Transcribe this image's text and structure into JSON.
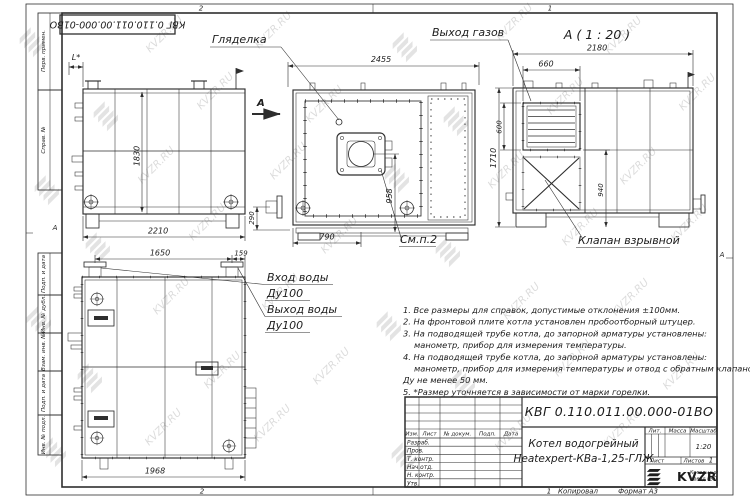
{
  "sheet": {
    "doc_number": "КВГ 0.110.011.00.000-01ВО",
    "watermark_text": "KVZR.RU",
    "zone_top_left": "2",
    "zone_top_right": "1",
    "zone_bottom_left": "2",
    "marker_left": "А",
    "marker_right": "А",
    "margin": {
      "perv": "Перв. примен.",
      "sprav": "Справ. №",
      "podp1": "Подп. и дата",
      "dubl": "Инв. № дубл.",
      "vzam": "Взам. инв. №",
      "podp2": "Подп. и дата",
      "podl": "Инв. № подл."
    }
  },
  "views": {
    "side": {
      "dim_l": "L*",
      "dim_h": "1830",
      "dim_w": "2210"
    },
    "front": {
      "sight": "Гляделка",
      "see_note": "См.п.2",
      "cut": "А",
      "dim_w": "2455",
      "dim_flue": "958",
      "dim_base": "790",
      "dim_pipe": "290"
    },
    "section": {
      "title": "А ( 1 : 20 )",
      "gas": "Выход газов",
      "valve": "Клапан взрывной",
      "dim_w": "2180",
      "dim_gw": "660",
      "dim_gh": "600",
      "dim_vh": "940",
      "dim_h": "1710"
    },
    "plan": {
      "inlet": "Вход воды",
      "outlet": "Выход воды",
      "dn": "Ду100",
      "dim_a": "1650",
      "dim_b": "159",
      "dim_w": "1968"
    }
  },
  "notes": {
    "lines": [
      "1. Все размеры для справок, допустимые отклонения ±100мм.",
      "2. На фронтовой плите котла установлен пробоотборный штуцер.",
      "3. На подводящей трубе котла, до запорной арматуры установлены:",
      "манометр, прибор для измерения температуры.",
      "4. На подводящей трубе котла, до запорной арматуры установлены:",
      "манометр, прибор для измерения температуры и отвод с обратным клапаном",
      "Ду не менее 50 мм.",
      "5. *Размер уточняется в зависимости от марки горелки."
    ]
  },
  "title_block": {
    "product_name_1": "Котел водогрейный",
    "product_name_2": "Heatexpert-КВа-1,25-ГЛЖ",
    "cols": {
      "izm": "Изм.",
      "list": "Лист",
      "doc": "№ докум.",
      "podp": "Подп.",
      "data": "Дата"
    },
    "rows": {
      "razrab": "Разраб.",
      "prov": "Пров.",
      "tkontr": "Т. контр.",
      "nachotd": "Нач.отд.",
      "nkontr": "Н. контр.",
      "utv": "Утв."
    },
    "right": {
      "lit": "Лит.",
      "massa": "Масса",
      "masshtab": "Масштаб",
      "scale": "1:20",
      "list": "Лист",
      "listov": "Листов",
      "listov_val": "1"
    },
    "logo": {
      "text": "KVZR",
      "caption_1": "Котельный",
      "caption_2": "завод РЭП"
    }
  },
  "footer": {
    "num": "1",
    "copied": "Копировал",
    "format": "Формат А3"
  }
}
